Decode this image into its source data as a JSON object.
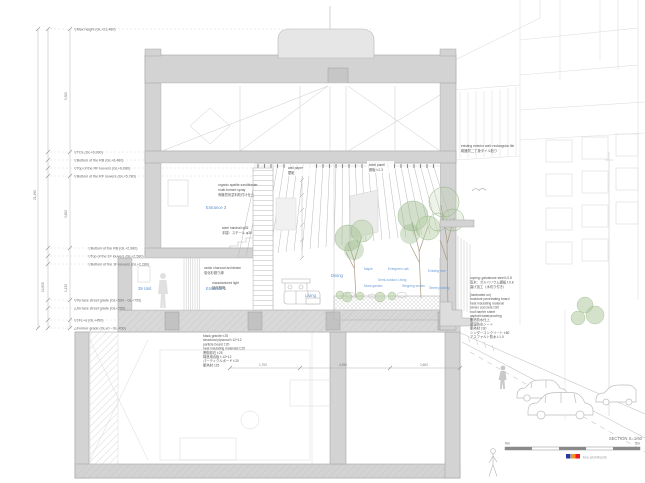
{
  "title": "Residential building cross section drawing",
  "levels": {
    "max_height": "▽Max height (GL+21,480)",
    "tol": "▽TOL (GL+6,990)",
    "bottom_rb": "▽Bottom of the RB (GL+6,480)",
    "top_rf_louvers": "▽Top of the RF louvers (GL+6,080)",
    "bottom_rf_louvers": "▽Bottom of the RF louvers (GL+5,780)",
    "bottom_2f_rb": "▽Bottom of the RB (GL+2,980)",
    "top_1f_louvers": "▽Top of the 1F louvers (GL+2,580)",
    "bottom_1f_louvers": "▽Bottom of the 1F louvers (GL+2,280)",
    "terrace_grade_v": "▽Terrace street grade (GL+500 - GL+750)",
    "terrace_grade_a": "△Terrace street grade (GL+750)",
    "fl1_alpha": "▽1FL+α (GL+450)",
    "former_grade": "△Former grade (GL±0 - GL-450)"
  },
  "dimensions": {
    "total_height": "21,480",
    "left_total": "14,850",
    "seg_top": "5,300",
    "seg_mid": "3,600",
    "seg_low": "1,130",
    "bottom": [
      "1,700",
      "4,550",
      "2,600"
    ]
  },
  "rooms": {
    "entrance3": "Entrance 3",
    "unit39": "39 Unit",
    "entrance1": "Entrance 1",
    "dining": "Dining",
    "living": "Living"
  },
  "garden_labels": [
    "Maple",
    "Evergreen oak",
    "Semi-outdoor Living",
    "Moss garden",
    "Stepping stones",
    "Existing tree",
    "Street planting"
  ],
  "annotations": {
    "wall_finish": [
      "organic apatite sandblaster",
      "multi-formed spray",
      "有機質系塗料吹付け仕上"
    ],
    "louver_left": [
      "wall paper",
      "壁紙"
    ],
    "louver_right": [
      "steel panel",
      "鋼板 t:2.3"
    ],
    "existing_wall": [
      "existing exterior wall: rectangular tile",
      "磁器質二丁掛タイル貼り"
    ],
    "architrave": [
      "cedar charcoal architrave",
      "炭化杉廻り縁"
    ],
    "light": [
      "manufactured light",
      "製作照明"
    ],
    "handrail": [
      "steel handrail φ35",
      "手摺：スチール φ35"
    ],
    "coping": [
      "coping: galvalume steel t:0.8",
      "笠木：ガルバリウム鋼板 t:0.8",
      "曲げ加工（水切り付き）"
    ],
    "roof_spec": [
      "(laminated on)",
      "moisture penetrating board",
      "heat insulating material",
      "cinder concrete t:80",
      "roof barrier sheet",
      "asphalt waterproofing",
      "断熱防水仕上",
      "透湿防水シート",
      "断熱材 t:30",
      "シンダーコンクリート t:80",
      "アスファルト防水 t:1.0"
    ],
    "floor_spec": [
      "black granite t:25",
      "structural plywood t:12+12",
      "particle board t:20",
      "heat insulating materials t:25",
      "黒御影石 t:25",
      "構造用合板 t:12+12",
      "パーティクルボード t:20",
      "断熱材 t:25"
    ]
  },
  "footer": {
    "section_label": "SECTION  S=1/60",
    "scale_start": "0m",
    "scale_end": "5m",
    "credit": "tna architects"
  },
  "colors": {
    "wall_gray": "#d3d3d3",
    "label_blue": "#5b8fd0",
    "tree_green": "#9cbb8c",
    "logo_blue": "#2b3990",
    "logo_orange": "#f7941d",
    "logo_red": "#ed1c24"
  }
}
